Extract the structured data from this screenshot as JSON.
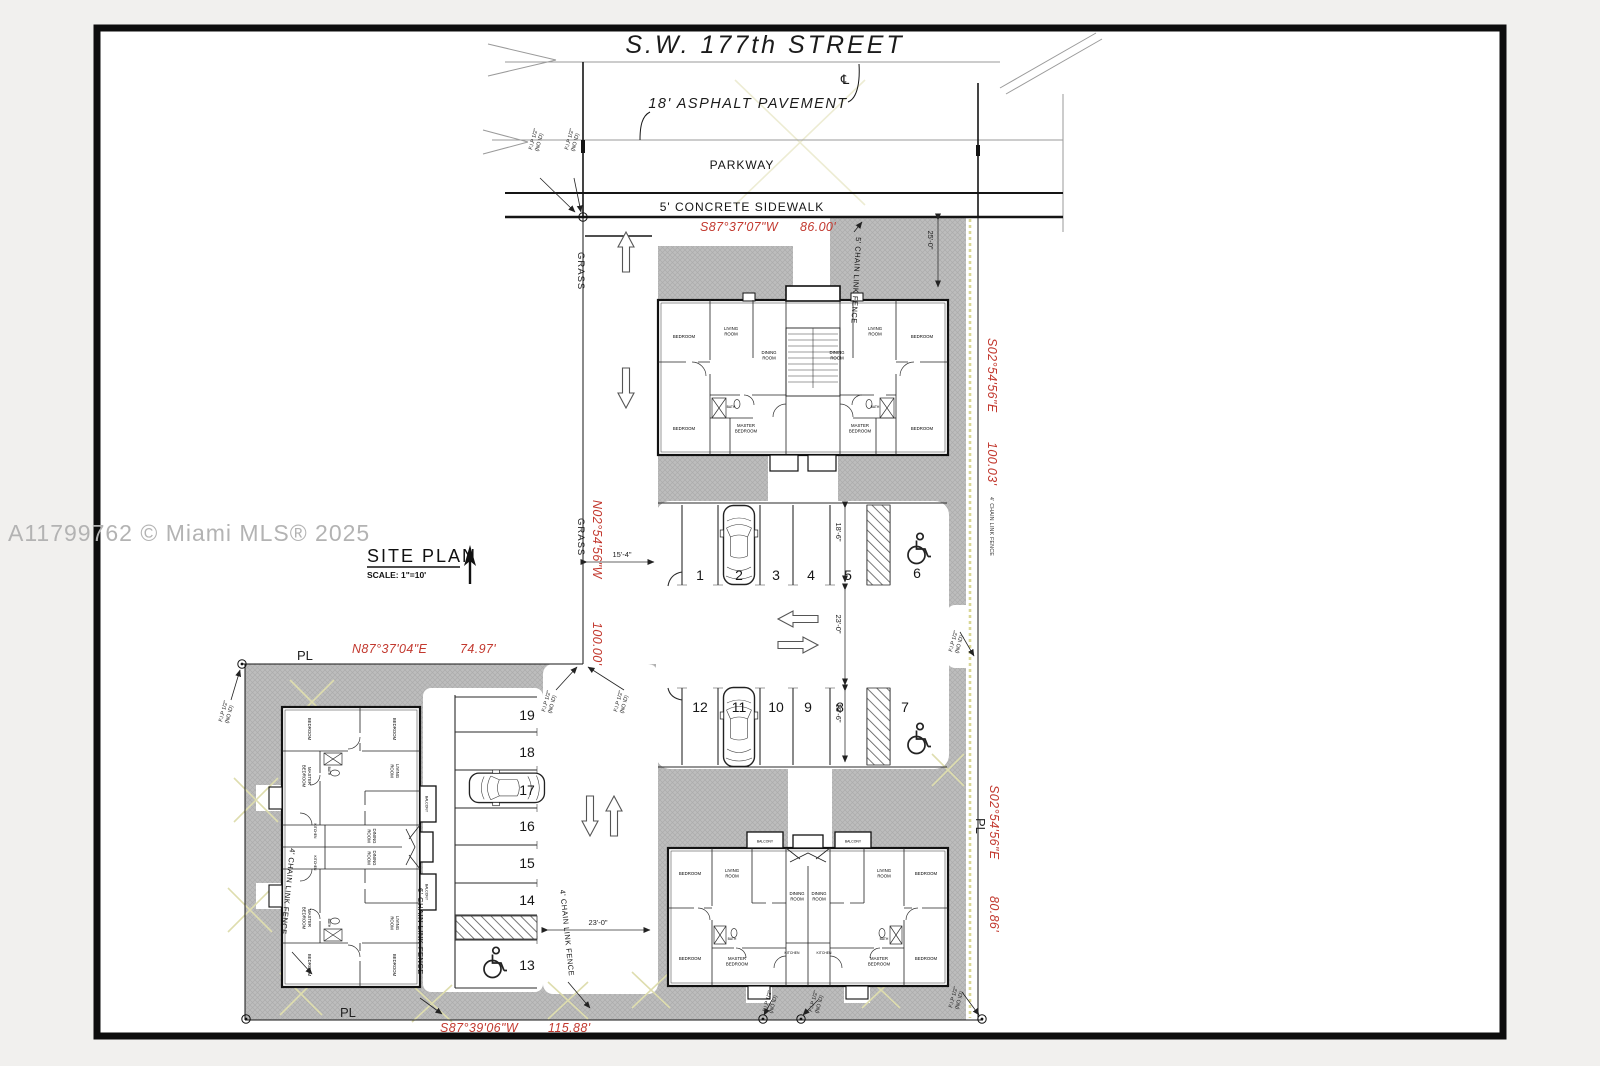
{
  "watermark": "A11799762 © Miami MLS® 2025",
  "title_block": {
    "title": "SITE PLAN",
    "scale": "SCALE: 1\"=10'"
  },
  "street": {
    "name": "S.W. 177th STREET",
    "centerline_symbol": "℄",
    "asphalt": "18' ASPHALT PAVEMENT",
    "parkway": "PARKWAY",
    "sidewalk": "5' CONCRETE SIDEWALK"
  },
  "bearings": {
    "north": {
      "dir": "S87°37'07\"W",
      "len": "86.00'"
    },
    "west": {
      "dir": "N02°54'56\"W",
      "len": "100.00'"
    },
    "east_upper": {
      "dir": "S02°54'56\"E",
      "len": "100.03'"
    },
    "lower_north": {
      "dir": "N87°37'04\"E",
      "len": "74.97'"
    },
    "east_lower": {
      "dir": "S02°54'56\"E",
      "len": "80.86'"
    },
    "south": {
      "dir": "S87°39'06\"W",
      "len": "115.88'"
    }
  },
  "labels": {
    "grass": "GRASS",
    "pl": "PL",
    "fip1": "F.I.P 1/2\"",
    "fip2": "(NO ID)",
    "fence5": "5' CHAIN LINK FENCE",
    "fence4": "4' CHAIN LINK FENCE",
    "fence6": "6' CHAIN LINK FENCE"
  },
  "dims": {
    "stall": "18'-6\"",
    "aisle": "23'-0\"",
    "drive": "15'-4\"",
    "setback": "25'-0\""
  },
  "parking": {
    "top_row": [
      "1",
      "2",
      "3",
      "4",
      "5",
      "6"
    ],
    "bottom_row": [
      "12",
      "11",
      "10",
      "9",
      "8",
      "7"
    ],
    "west_column": [
      "19",
      "18",
      "17",
      "16",
      "15",
      "14",
      "13"
    ]
  },
  "rooms": {
    "bedroom": "BEDROOM",
    "living1": "LIVING",
    "living2": "ROOM",
    "dining1": "DINING",
    "dining2": "ROOM",
    "master1": "MASTER",
    "master2": "BEDROOM",
    "bath": "BATH",
    "kitchen": "KITCHEN",
    "balcony": "BALCONY"
  }
}
